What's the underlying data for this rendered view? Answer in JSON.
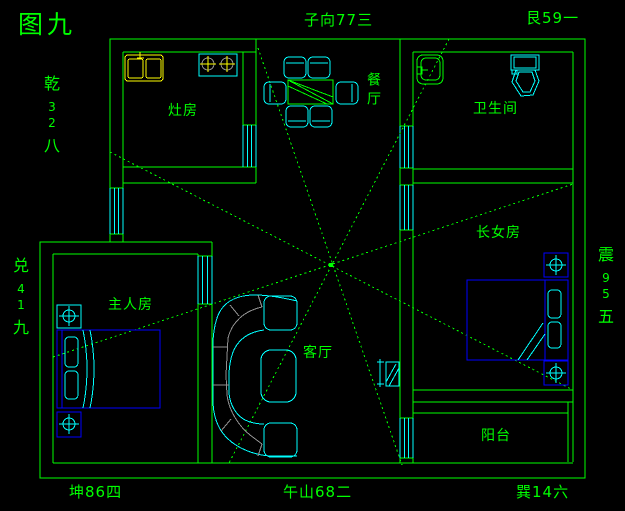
{
  "figure_title": "图九",
  "compass": {
    "top_center": "子向77三",
    "top_right": "艮59一",
    "bottom_left": "坤86四",
    "bottom_center": "午山68二",
    "bottom_right": "巽14六",
    "northwest_column": [
      "乾",
      "3",
      "2",
      "八"
    ],
    "west_column": [
      "兑",
      "4",
      "1",
      "九"
    ],
    "east_column": [
      "震",
      "9",
      "5",
      "五"
    ]
  },
  "rooms": {
    "kitchen": "灶房",
    "dining": "餐厅",
    "bathroom": "卫生间",
    "eldest_daughter": "长女房",
    "master": "主人房",
    "living": "客厅",
    "balcony": "阳台"
  },
  "colors": {
    "background": "#000000",
    "wall_green": "#00FF00",
    "furniture_cyan": "#00FFFF",
    "fixture_yellow": "#FFFF00",
    "bed_blue": "#0000FF",
    "sofa_gray": "#909090"
  }
}
